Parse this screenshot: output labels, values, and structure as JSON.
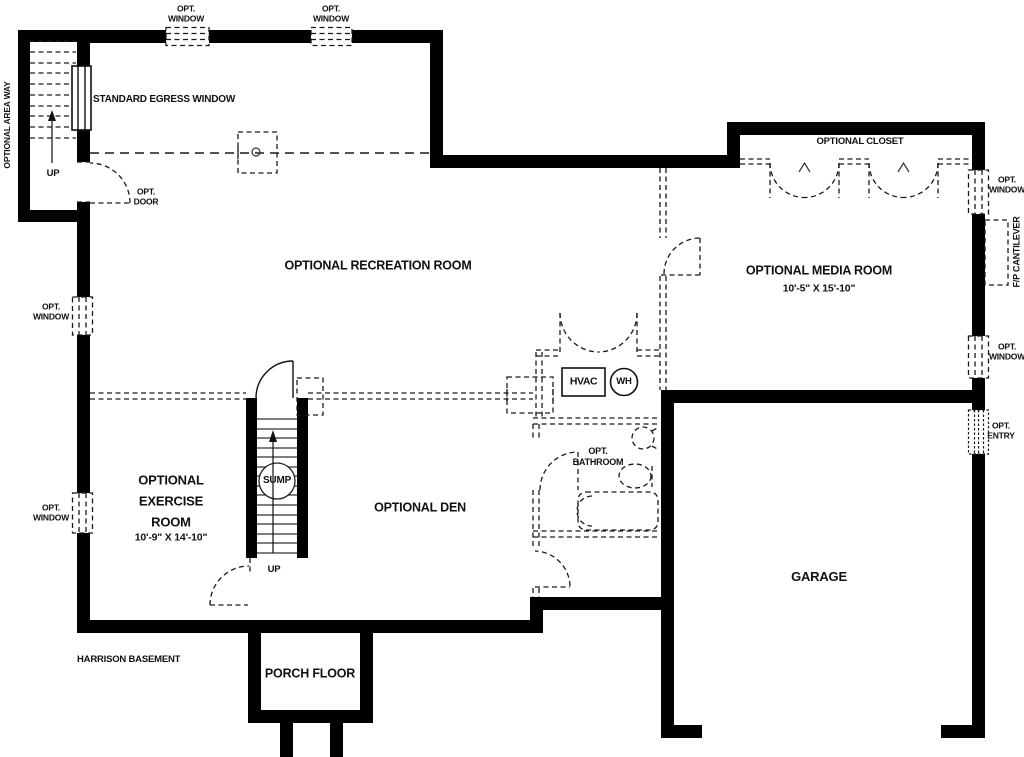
{
  "plan_title": "HARRISON BASEMENT",
  "rooms": {
    "recreation": {
      "name": "OPTIONAL RECREATION ROOM"
    },
    "media": {
      "name": "OPTIONAL MEDIA ROOM",
      "dims": "10'-5\" X 15'-10\""
    },
    "exercise": {
      "name": "OPTIONAL\nEXERCISE\nROOM",
      "dims": "10'-9\" X 14'-10\""
    },
    "den": {
      "name": "OPTIONAL DEN"
    },
    "bathroom": {
      "name": "OPT.\nBATHROOM"
    },
    "garage": {
      "name": "GARAGE"
    },
    "porch": {
      "name": "PORCH FLOOR"
    }
  },
  "annotations": {
    "opt_window": "OPT.\nWINDOW",
    "opt_door": "OPT.\nDOOR",
    "opt_entry": "OPT.\nENTRY",
    "optional_closet": "OPTIONAL CLOSET",
    "standard_egress_window": "STANDARD EGRESS WINDOW",
    "optional_area_way": "OPTIONAL AREA WAY",
    "fp_cantilever": "F/P CANTILEVER",
    "up": "UP"
  },
  "equipment": {
    "hvac": "HVAC",
    "water_heater": "WH",
    "sump": "SUMP"
  },
  "colors": {
    "wall": "#000000",
    "dashed_line": "#1a1a1a",
    "background": "#ffffff",
    "text": "#111111"
  }
}
